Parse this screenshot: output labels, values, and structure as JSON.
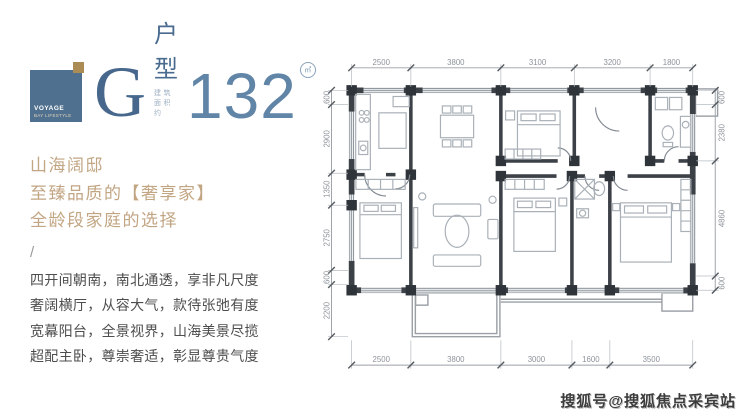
{
  "logo": {
    "mark_line1": "VOYAGE",
    "mark_line2": "BAY LIFESTYLE",
    "letter": "G",
    "type_label": "户型",
    "area_note": "建筑面积约",
    "area_value": "132",
    "area_unit": "㎡"
  },
  "headline": {
    "lines": [
      "山海阔邸",
      "至臻品质的【奢享家】",
      "全龄段家庭的选择"
    ]
  },
  "divider_glyph": "/",
  "body": {
    "lines": [
      "四开间朝南，南北通透，享非凡尺度",
      "奢阔横厅，从容大气，款待张弛有度",
      "宽幕阳台，全景视界，山海美景尽揽",
      "超配主卧，尊崇奢适，彰显尊贵气度"
    ]
  },
  "floorplan": {
    "dims": {
      "top": {
        "ticks": [
          0,
          2500,
          6300,
          9400,
          12600,
          14400
        ],
        "labels": [
          "2500",
          "3800",
          "3100",
          "3200",
          "1800"
        ]
      },
      "bottom": {
        "ticks": [
          0,
          2500,
          6300,
          9300,
          10900,
          14400
        ],
        "labels": [
          "2500",
          "3800",
          "3000",
          "1600",
          "3500"
        ]
      },
      "left": {
        "ticks": [
          0,
          600,
          3500,
          4850,
          7600,
          8200,
          10400
        ],
        "labels": [
          "600",
          "2900",
          "1350",
          "2750",
          "600",
          "2200"
        ]
      },
      "right": {
        "ticks": [
          0,
          600,
          2980,
          7840,
          8440
        ],
        "labels": [
          "600",
          "2380",
          "4860",
          "600"
        ]
      }
    }
  },
  "watermark": {
    "text": "搜狐号@搜狐焦点采宾站"
  },
  "colors": {
    "brand_blue": "#50708f",
    "accent_gold": "#ab8c55",
    "headline_tan": "#c2a583",
    "body_gray": "#4d4d4d",
    "wall_dark": "#3c4147"
  }
}
